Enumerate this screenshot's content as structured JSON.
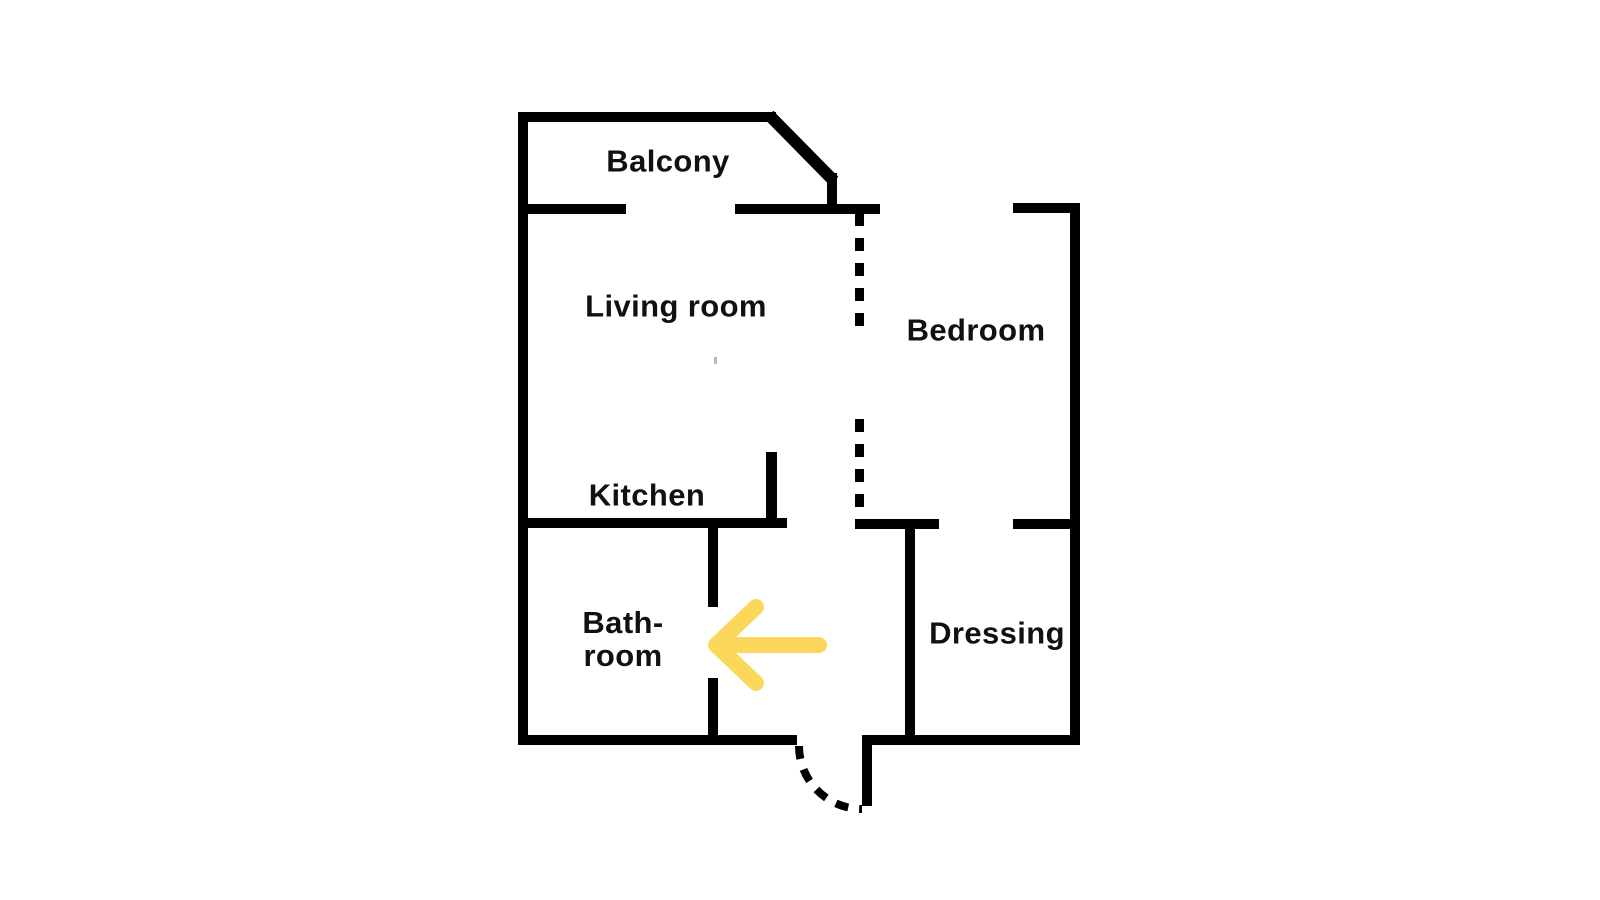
{
  "rooms": {
    "balcony": {
      "label": "Balcony"
    },
    "living_room": {
      "label": "Living room"
    },
    "bedroom": {
      "label": "Bedroom"
    },
    "kitchen": {
      "label": "Kitchen"
    },
    "bathroom": {
      "label_line1": "Bath-",
      "label_line2": "room"
    },
    "dressing": {
      "label": "Dressing"
    }
  },
  "annotations": {
    "arrow": {
      "shape": "left-arrow",
      "points_at": "bathroom-door"
    }
  },
  "colors": {
    "wall": "#000000",
    "text": "#111111",
    "arrow": "#FBD75B",
    "background": "#FFFFFF"
  }
}
